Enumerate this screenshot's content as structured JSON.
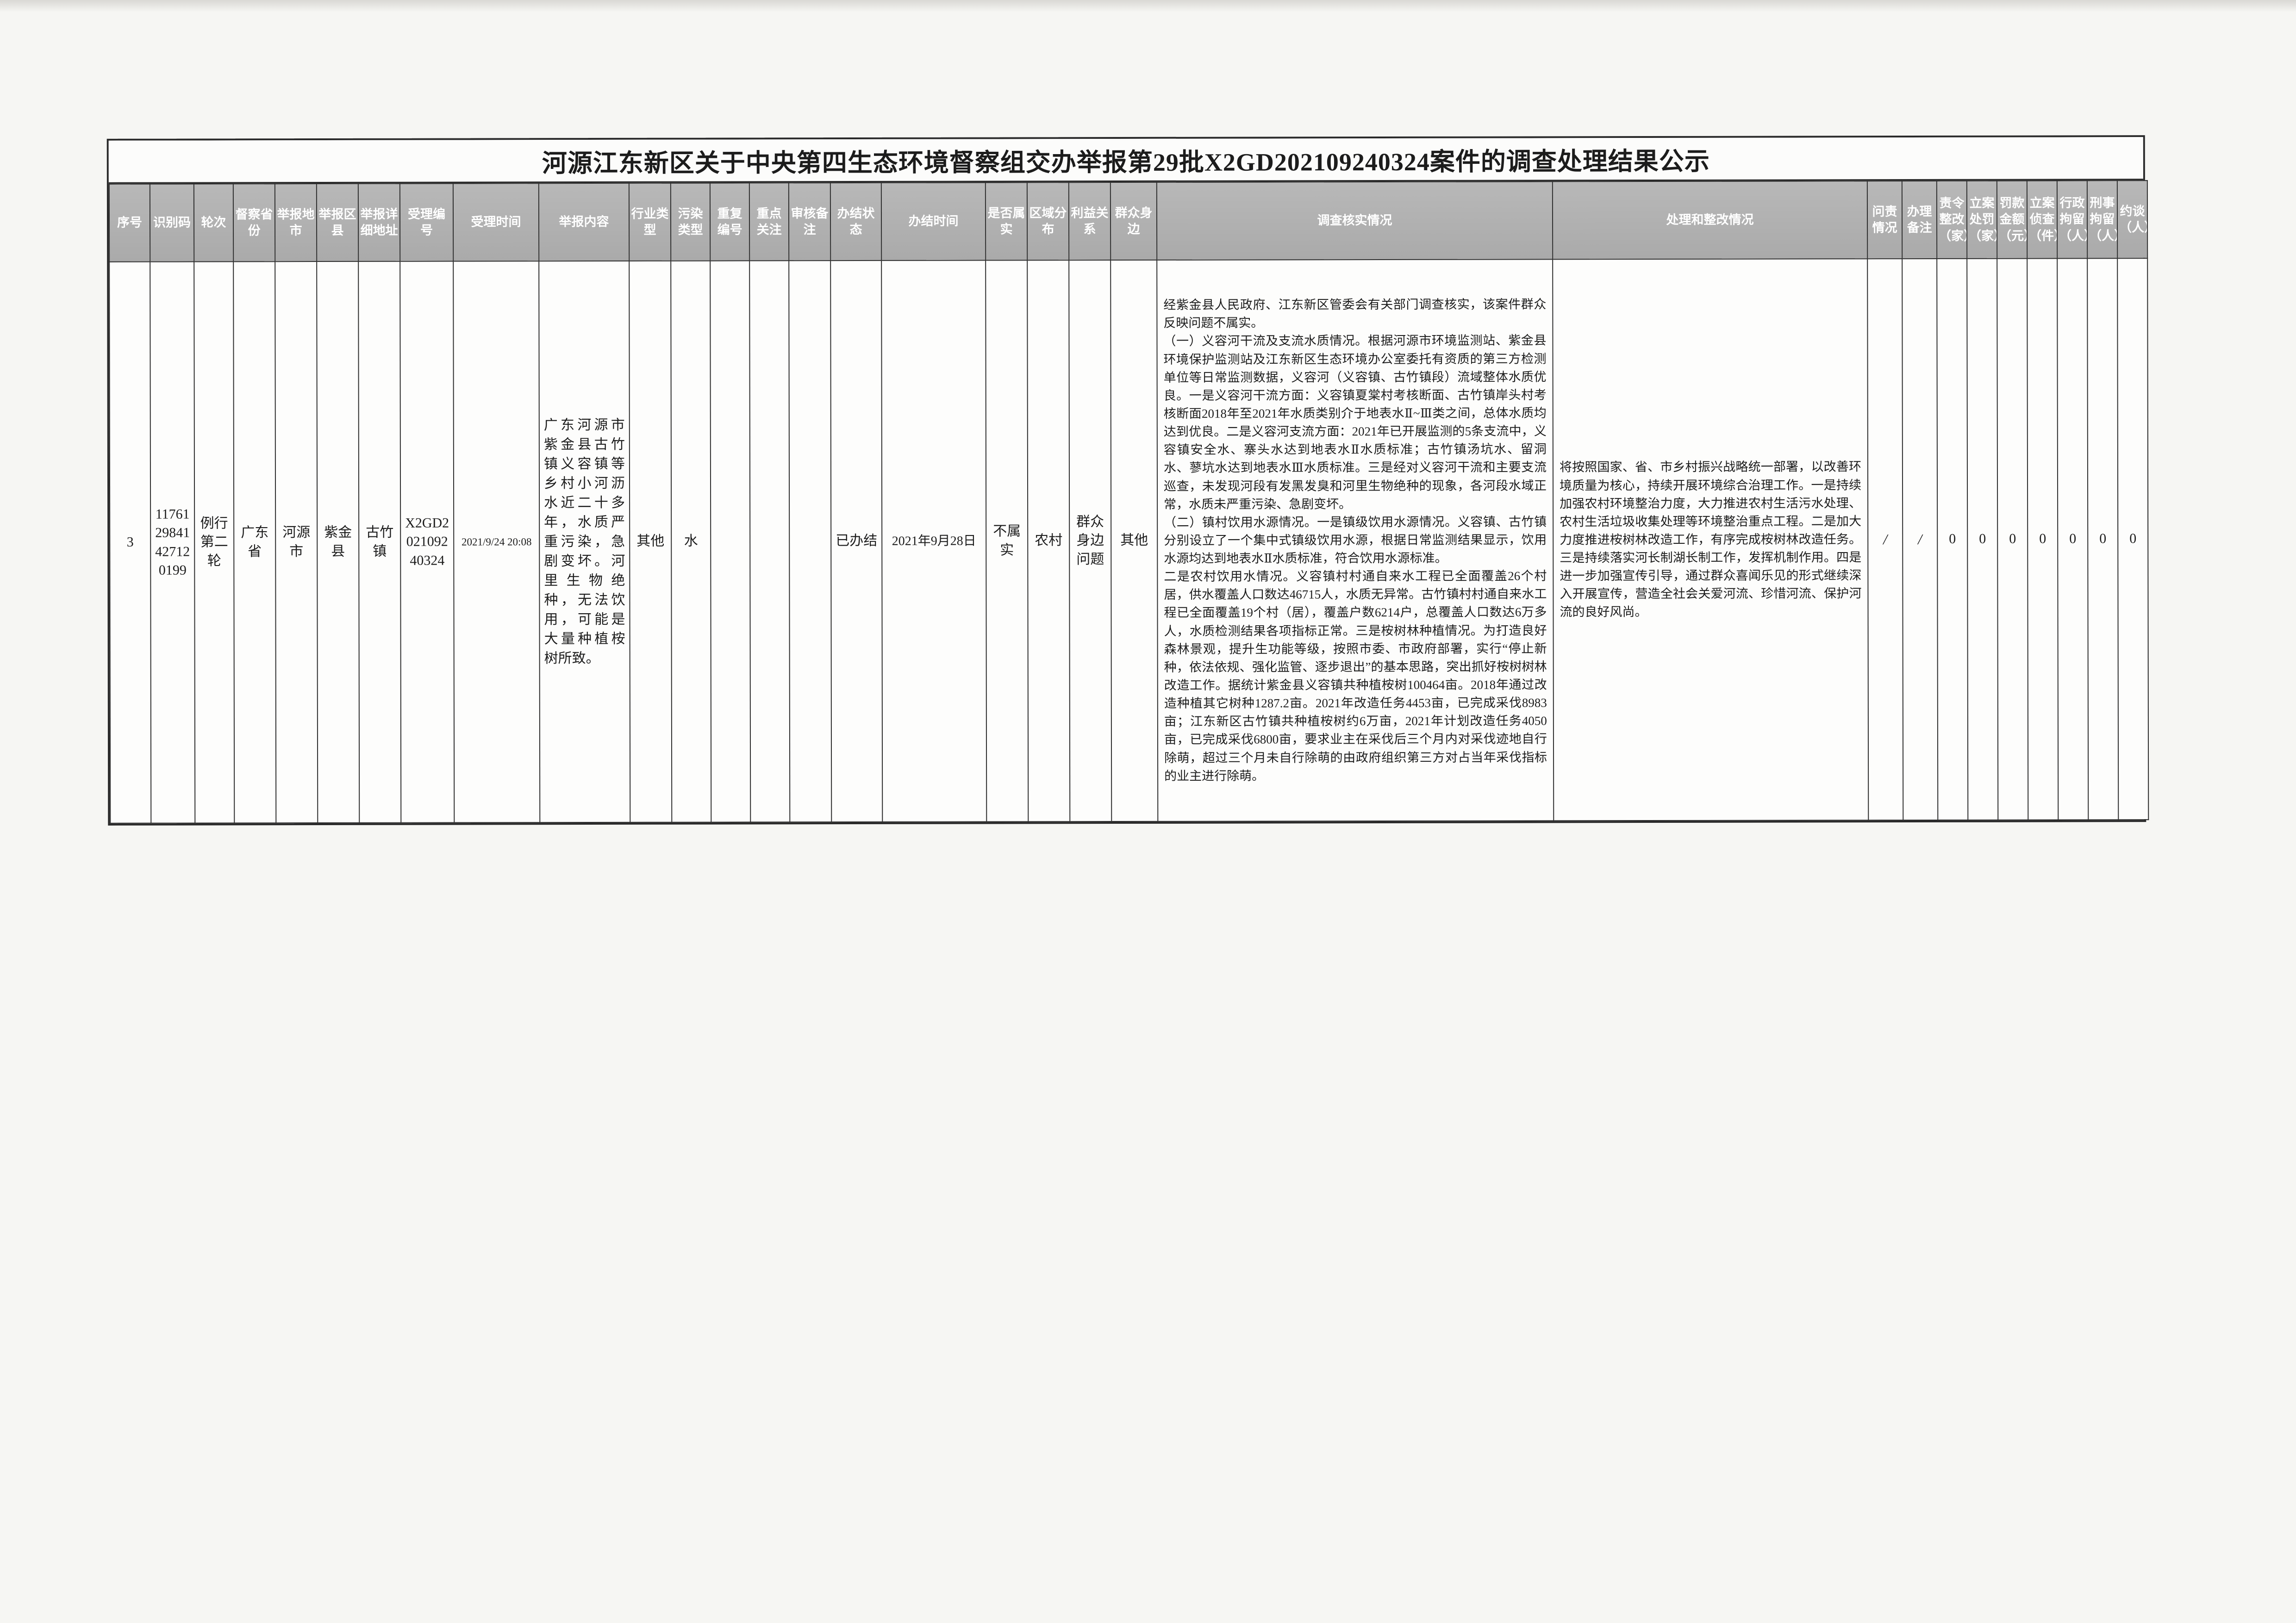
{
  "page": {
    "title": "河源江东新区关于中央第四生态环境督察组交办举报第29批X2GD202109240324案件的调查处理结果公示"
  },
  "table": {
    "headers": [
      "序号",
      "识别码",
      "轮次",
      "督察省份",
      "举报地市",
      "举报区县",
      "举报详细地址",
      "受理编号",
      "受理时间",
      "举报内容",
      "行业类型",
      "污染类型",
      "重复编号",
      "重点关注",
      "审核备注",
      "办结状态",
      "办结时间",
      "是否属实",
      "区域分布",
      "利益关系",
      "群众身边",
      "调查核实情况",
      "处理和整改情况",
      "问责情况",
      "办理备注",
      "责令整改（家）",
      "立案处罚（家）",
      "罚款金额（元）",
      "立案侦查（件）",
      "行政拘留（人）",
      "刑事拘留（人）",
      "约谈（人）"
    ],
    "row": {
      "cells": [
        "3",
        "1176129841427120199",
        "例行第二轮",
        "广东省",
        "河源市",
        "紫金县",
        "古竹镇",
        "X2GD202109240324",
        "2021/9/24 20:08",
        "广东河源市紫金县古竹镇义容镇等乡村小河沥水近二十多年，水质严重污染，急剧变坏。河里生物绝种，无法饮用，可能是大量种植桉树所致。",
        "其他",
        "水",
        "",
        "",
        "",
        "已办结",
        "2021年9月28日",
        "不属实",
        "农村",
        "群众身边问题",
        "其他",
        "经紫金县人民政府、江东新区管委会有关部门调查核实，该案件群众反映问题不属实。\n（一）义容河干流及支流水质情况。根据河源市环境监测站、紫金县环境保护监测站及江东新区生态环境办公室委托有资质的第三方检测单位等日常监测数据，义容河（义容镇、古竹镇段）流域整体水质优良。一是义容河干流方面：义容镇夏棠村考核断面、古竹镇岸头村考核断面2018年至2021年水质类别介于地表水Ⅱ~Ⅲ类之间，总体水质均达到优良。二是义容河支流方面：2021年已开展监测的5条支流中，义容镇安全水、寨头水达到地表水Ⅱ水质标准；古竹镇汤坑水、留洞水、蓼坑水达到地表水Ⅲ水质标准。三是经对义容河干流和主要支流巡查，未发现河段有发黑发臭和河里生物绝种的现象，各河段水域正常，水质未严重污染、急剧变坏。\n（二）镇村饮用水源情况。一是镇级饮用水源情况。义容镇、古竹镇分别设立了一个集中式镇级饮用水源，根据日常监测结果显示，饮用水源均达到地表水Ⅱ水质标准，符合饮用水源标准。\n二是农村饮用水情况。义容镇村村通自来水工程已全面覆盖26个村居，供水覆盖人口数达46715人，水质无异常。古竹镇村村通自来水工程已全面覆盖19个村（居），覆盖户数6214户，总覆盖人口数达6万多人，水质检测结果各项指标正常。三是桉树林种植情况。为打造良好森林景观，提升生功能等级，按照市委、市政府部署，实行“停止新种，依法依规、强化监管、逐步退出”的基本思路，突出抓好桉树树林改造工作。据统计紫金县义容镇共种植桉树100464亩。2018年通过改造种植其它树种1287.2亩。2021年改造任务4453亩，已完成采伐8983亩；江东新区古竹镇共种植桉树约6万亩，2021年计划改造任务4050亩，已完成采伐6800亩，要求业主在采伐后三个月内对采伐迹地自行除萌，超过三个月未自行除萌的由政府组织第三方对占当年采伐指标的业主进行除萌。",
        "将按照国家、省、市乡村振兴战略统一部署，以改善环境质量为核心，持续开展环境综合治理工作。一是持续加强农村环境整治力度，大力推进农村生活污水处理、农村生活垃圾收集处理等环境整治重点工程。二是加大力度推进桉树林改造工作，有序完成桉树林改造任务。三是持续落实河长制湖长制工作，发挥机制作用。四是进一步加强宣传引导，通过群众喜闻乐见的形式继续深入开展宣传，营造全社会关爱河流、珍惜河流、保护河流的良好风尚。",
        "/",
        "/",
        "0",
        "0",
        "0",
        "0",
        "0",
        "0",
        "0"
      ]
    }
  },
  "colors": {
    "header_bg": "#b0b0b0",
    "header_text": "#ffffff",
    "border": "#2e2e2e",
    "page_bg": "#f6f6f3"
  }
}
